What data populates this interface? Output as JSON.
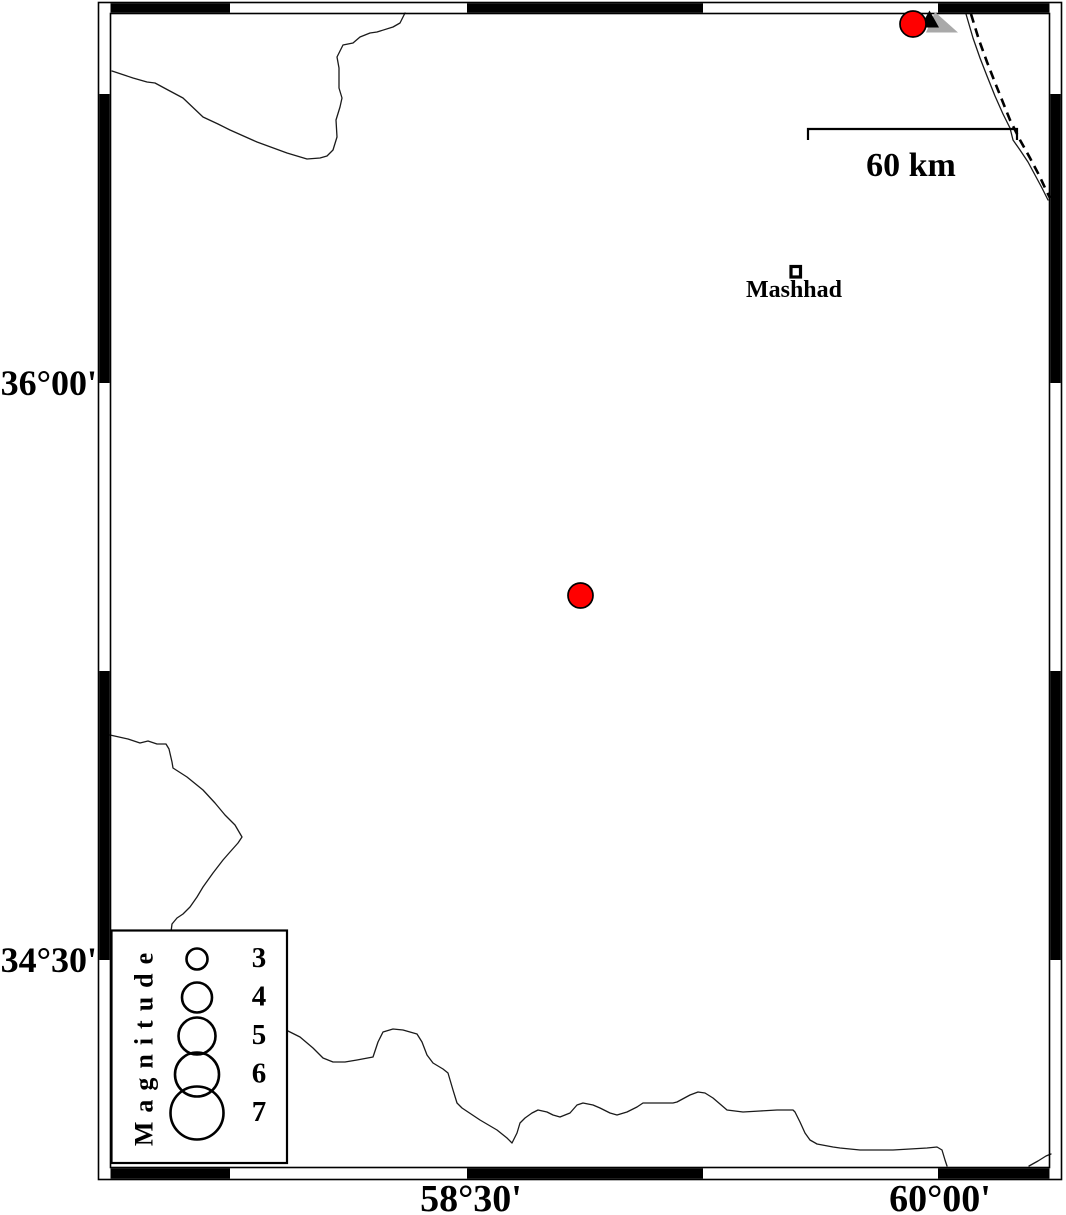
{
  "map": {
    "axis": {
      "left": [
        {
          "label": "36°00'",
          "y_px": 383
        },
        {
          "label": "34°30'",
          "y_px": 960
        }
      ],
      "bottom": [
        {
          "label": "58°30'",
          "x_px": 471
        },
        {
          "label": "60°00'",
          "x_px": 940
        }
      ]
    },
    "scale_bar": {
      "label": "60 km",
      "length_px": 209
    },
    "city": {
      "name": "Mashhad",
      "x_px": 795,
      "y_px": 272,
      "approx_lon_e": 59.55,
      "approx_lat_n": 36.29
    },
    "earthquakes": [
      {
        "x_px": 913,
        "y_px": 24,
        "radius_px": 13,
        "approx_lon_e": 59.92,
        "approx_lat_n": 36.93
      },
      {
        "x_px": 580.5,
        "y_px": 595.5,
        "radius_px": 12.5,
        "approx_lon_e": 58.86,
        "approx_lat_n": 35.45
      }
    ],
    "station": {
      "symbol": "triangle-with-gray-shadow",
      "x_px": 930,
      "y_px": 19
    },
    "legend": {
      "title": "Magnitude",
      "entries": [
        {
          "label": "3",
          "radius_px": 10.5
        },
        {
          "label": "4",
          "radius_px": 15
        },
        {
          "label": "5",
          "radius_px": 18.5
        },
        {
          "label": "6",
          "radius_px": 22
        },
        {
          "label": "7",
          "radius_px": 26.5
        }
      ]
    },
    "colors": {
      "epicenter_red": "#ff0000",
      "shadow_gray": "#a9a9a9",
      "frame_black": "#000000"
    }
  }
}
